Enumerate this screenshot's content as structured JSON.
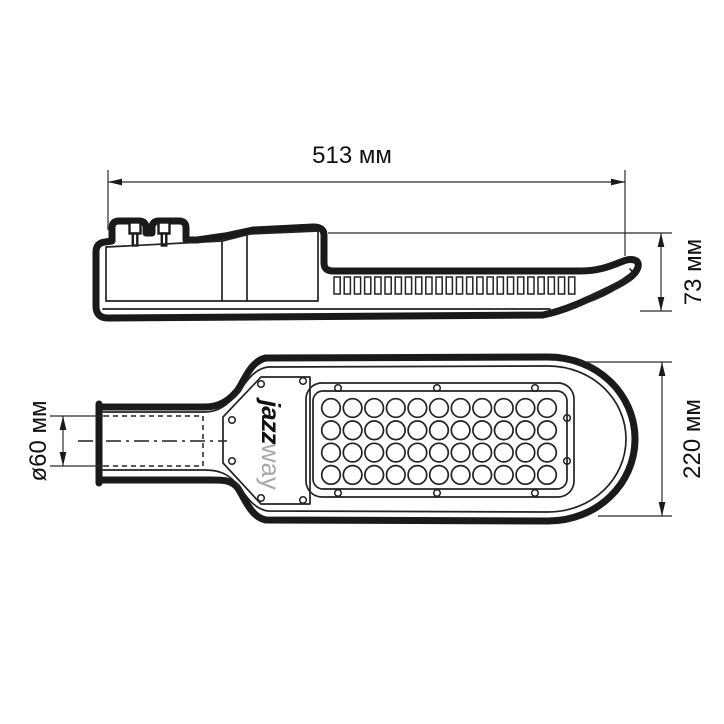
{
  "labels": {
    "length": "513 мм",
    "height": "73 мм",
    "width": "220 мм",
    "pipe_diameter": "ø60 мм"
  },
  "logo": {
    "bold": "jazz",
    "light": "way"
  },
  "led_grid": {
    "rows": 4,
    "columns": 11
  },
  "fins": {
    "count": 24
  },
  "colors": {
    "line": "#1a1a1a",
    "logo_light": "#a8a8a8",
    "background": "#ffffff"
  }
}
